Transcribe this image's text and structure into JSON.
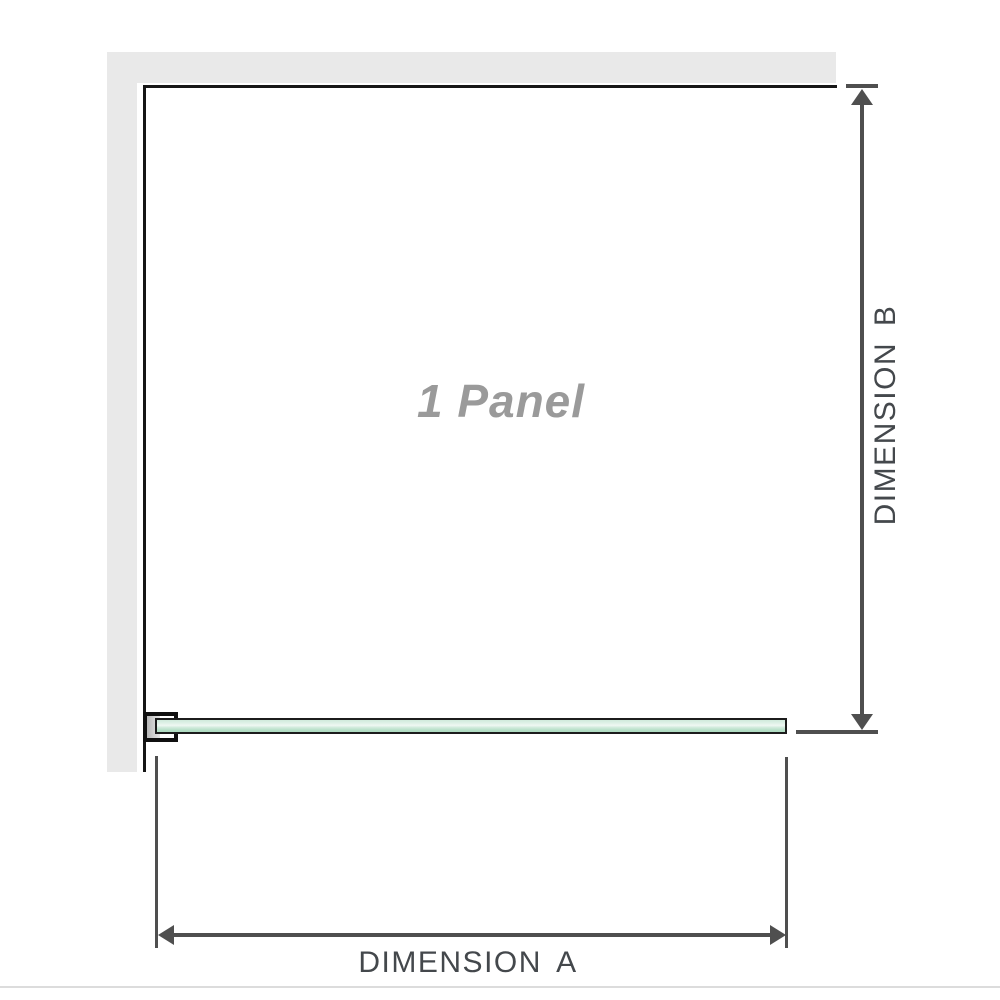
{
  "diagram": {
    "panel_title": "1 Panel",
    "dimension_a": {
      "label": "DIMENSION A"
    },
    "dimension_b": {
      "label": "DIMENSION B"
    }
  },
  "icons": {
    "arrow_up": "triangle-up",
    "arrow_down": "triangle-down",
    "arrow_left": "triangle-left",
    "arrow_right": "triangle-right"
  },
  "colors": {
    "background": "#ffffff",
    "wall_fill": "#e9e9e9",
    "panel_outline": "#161616",
    "glass_border": "#1c1c1c",
    "glass_fill_light": "#f0f8f3",
    "glass_fill_green": "#b5dfc6",
    "bracket_outline": "#101010",
    "bracket_pad": "#c2c2c2",
    "dimension_line": "#4f4f4f",
    "dimension_text": "#44484c",
    "panel_title_text": "#9a9a9a",
    "footer_rule": "#dcdcdc"
  }
}
